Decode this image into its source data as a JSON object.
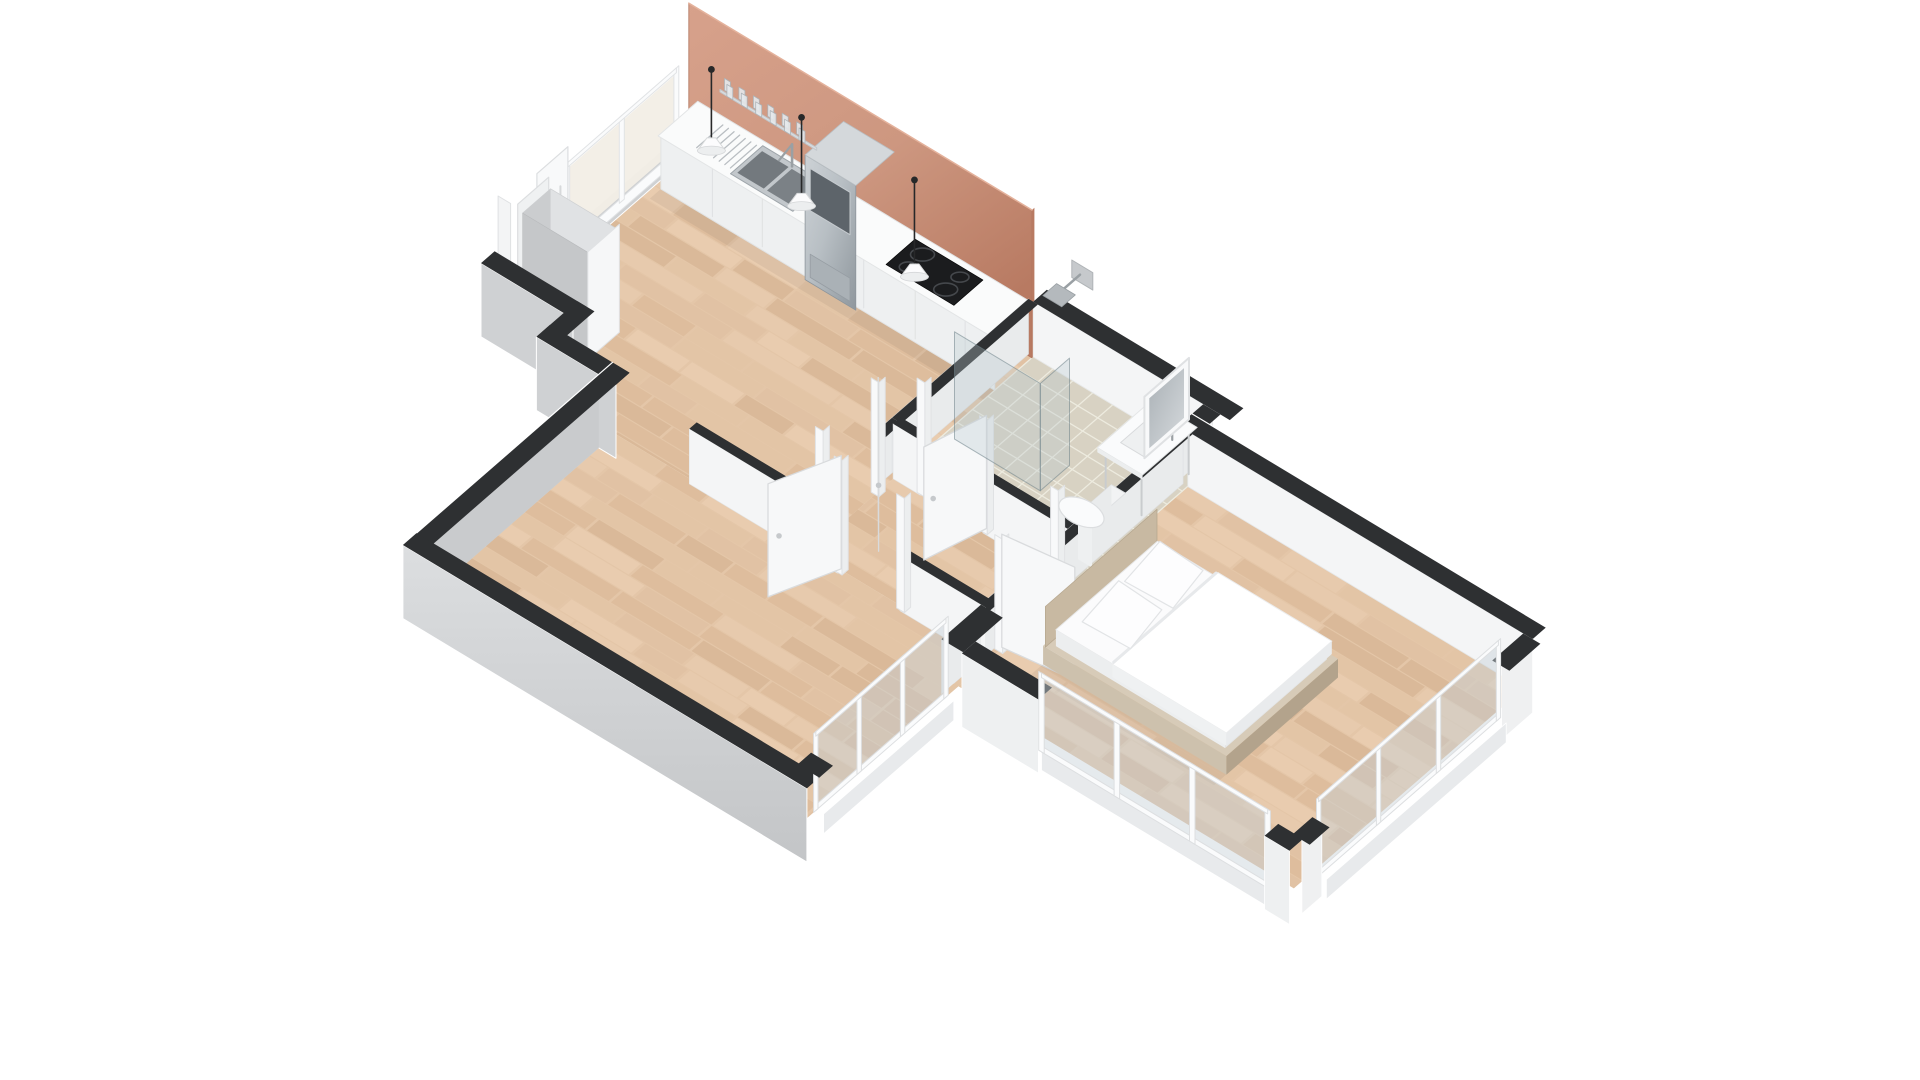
{
  "scene": {
    "title": "3D isometric cutaway floor plan of a one-bedroom apartment",
    "background": "#ffffff",
    "palette": {
      "white": "#ffffff",
      "wall_top": "#2e3032",
      "wall_interior": "#f4f5f6",
      "wall_interior_shaded": "#e9ebec",
      "wall_exterior": "#cfd1d3",
      "wall_exterior_dark": "#c3c5c7",
      "wall_skirt_light": "#e8eaec",
      "terracotta": "#cd9780",
      "terracotta_dark": "#b87a62",
      "wood_base": "#e4c6a8",
      "wood_planks": [
        "#ecd2b4",
        "#dfc0a0",
        "#d9b794",
        "#e9cdb0",
        "#e2c4a4",
        "#d2ae8c"
      ],
      "tile_base": "#d8d2c3",
      "tile_grout": "#edebdf",
      "steel": "#b8bfc4",
      "steel_dark": "#8f979d",
      "appliance_black": "#1b1c1e",
      "cooktop_ring": "#45484c",
      "glass": "rgba(183,200,206,0.32)",
      "glass_edge": "rgba(110,130,136,0.55)",
      "window_glass": "rgba(198,209,215,0.45)",
      "window_frame": "#fafbfc",
      "warm_glass": "#f2eee6",
      "bed_linen": "#fbfbfc",
      "bed_linen_shade": "#e7e9eb",
      "bed_tan": "#c8b9a2",
      "bed_tan_dark": "#b3a38c",
      "cabinet_gray": "#c5c7c9",
      "counter_white": "#fafbfb",
      "counter_face": "#eef0f1",
      "cord_black": "#272829",
      "shadow": "rgba(0,0,0,0.05)"
    },
    "counts": {
      "pendant_lights": 3,
      "glasses_on_shelf": 12,
      "bed_pillows": 2,
      "swing_door_leaves": 4,
      "sliding_entry_panels": 2,
      "kitchen_window_panes": 2,
      "living_window_panes": 3,
      "bedroom_south_window_panes": 3,
      "bedroom_east_window_panes": 3,
      "cooktop_rings": 4
    },
    "rooms": [
      {
        "id": "kitchen",
        "name": "Kitchen / open living area",
        "floor": "wood",
        "furniture": [
          "kitchen-counter",
          "double-steel-sink",
          "faucet",
          "dish-rack",
          "induction-cooktop",
          "tall-steel-appliance-column",
          "terracotta-backsplash-wall",
          "glass-shelf-with-glasses",
          "pendant-lights",
          "gray-wardrobe-block",
          "sliding-entry-door",
          "full-height-window"
        ]
      },
      {
        "id": "bathroom",
        "name": "Bathroom",
        "floor": "tile",
        "furniture": [
          "walk-in-shower-glass-screen",
          "wall-shower-head",
          "vanity-table-with-basin",
          "framed-mirror",
          "toilet",
          "door-to-hallway"
        ]
      },
      {
        "id": "hallway",
        "name": "Hallway",
        "floor": "wood",
        "furniture": [
          "door-to-kitchen",
          "door-to-bathroom",
          "door-to-bedroom",
          "door-to-living-room"
        ]
      },
      {
        "id": "bedroom",
        "name": "Bedroom",
        "floor": "wood",
        "furniture": [
          "double-bed",
          "tan-bed-platform",
          "headboard",
          "two-pillows",
          "duvet",
          "corner-window-walls",
          "open-door"
        ]
      },
      {
        "id": "living",
        "name": "Living room",
        "floor": "wood",
        "furniture": [
          "window-wall"
        ]
      }
    ]
  }
}
